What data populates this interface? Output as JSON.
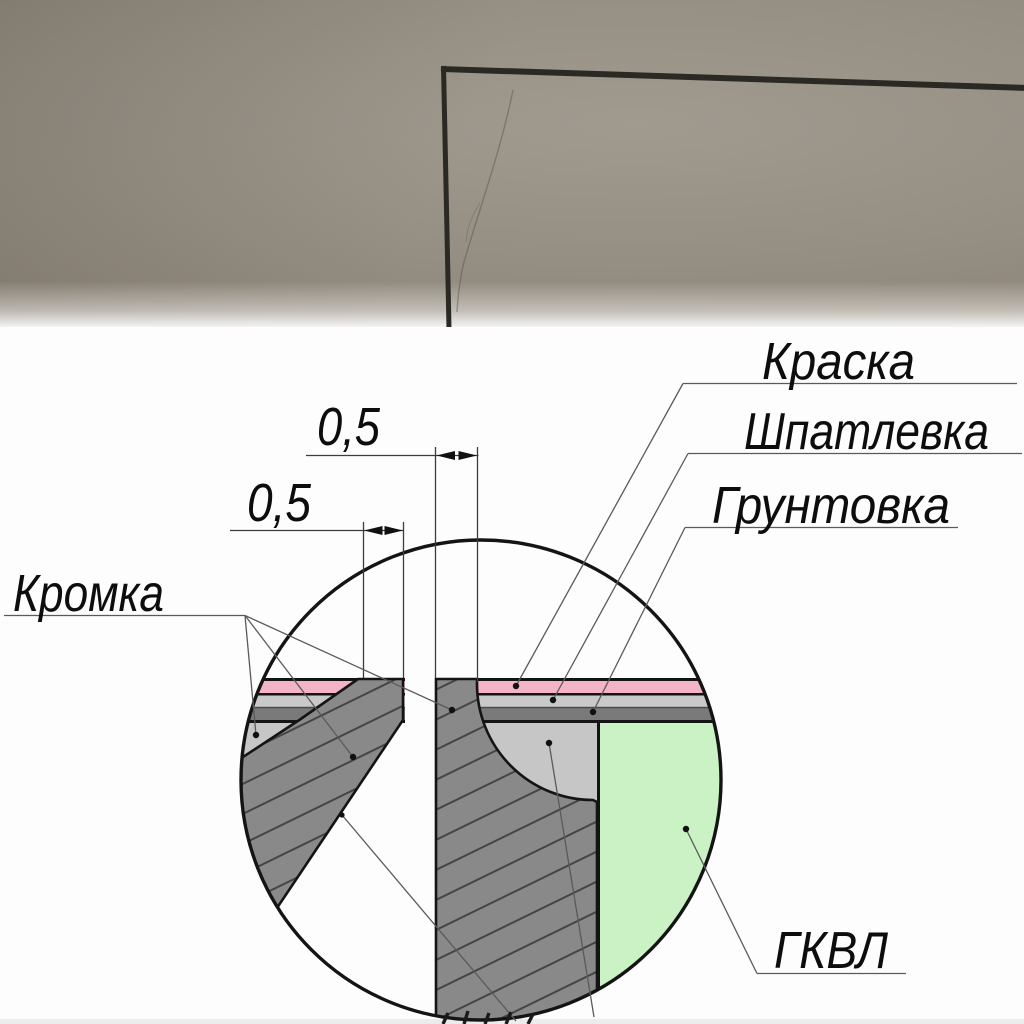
{
  "photo": {
    "wall_color": "#948d82",
    "corner_line_color": "#2a2923"
  },
  "diagram": {
    "dimensions": {
      "upper": "0,5",
      "lower": "0,5"
    },
    "labels": {
      "paint": "Краска",
      "putty": "Шпатлевка",
      "primer": "Грунтовка",
      "edge": "Кромка",
      "board": "ГКВЛ"
    },
    "colors": {
      "paint_layer": "#f3b4c3",
      "putty_layer": "#c9c9c9",
      "putty_fill": "#c6c6c6",
      "primer_layer": "#7a7a7a",
      "board_green": "#caf2c5",
      "hatch_fill": "#898989",
      "hatch_line": "#454545",
      "outline": "#141414",
      "leader": "#5a5a5a",
      "background": "#fdfdfd"
    }
  }
}
